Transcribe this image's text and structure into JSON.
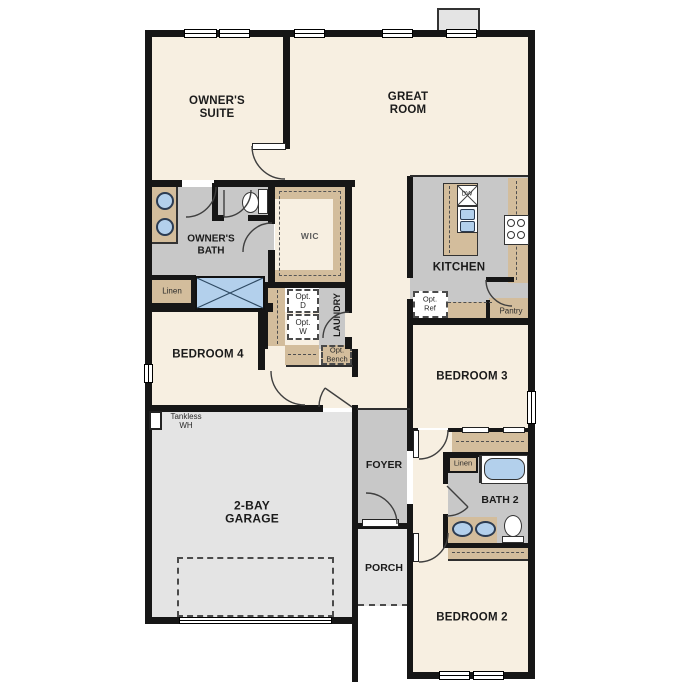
{
  "rooms": {
    "owners_suite": "OWNER'S SUITE",
    "great_room": "GREAT ROOM",
    "owners_bath": "OWNER'S BATH",
    "wic": "WIC",
    "kitchen": "KITCHEN",
    "laundry": "LAUNDRY",
    "bedroom4": "BEDROOM 4",
    "bedroom3": "BEDROOM 3",
    "bedroom2": "BEDROOM 2",
    "bath2": "BATH 2",
    "foyer": "FOYER",
    "porch": "PORCH",
    "garage": "2-BAY GARAGE"
  },
  "annotations": {
    "linen_left": "Linen",
    "linen_right": "Linen",
    "tankless_wh": "Tankless WH",
    "opt_d": "Opt. D",
    "opt_w": "Opt. W",
    "opt_bench": "Opt. Bench",
    "opt_ref": "Opt. Ref",
    "pantry": "Pantry",
    "dw": "DW"
  },
  "colors": {
    "wall": "#161616",
    "room": "#f7efe1",
    "wet_floor": "#c8c8c8",
    "garage_floor": "#e4e4e4",
    "cabinet": "#d3bd9c",
    "fixture_blue": "#b3d0ec"
  }
}
